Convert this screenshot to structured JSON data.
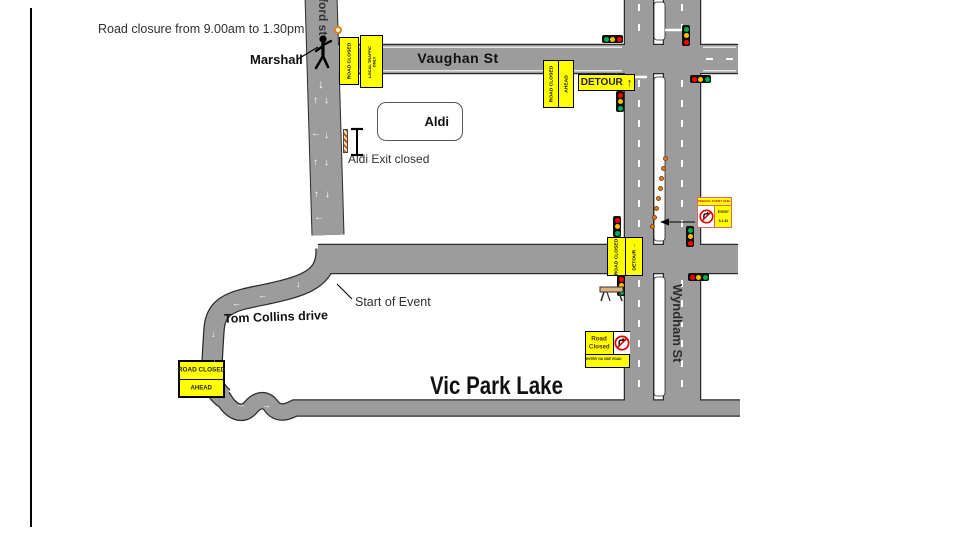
{
  "annotations": {
    "closure_note": "Road closure from 9.00am to 1.30pm",
    "marshall": "Marshall",
    "aldi_exit": "Aldi Exit closed",
    "start_of_event": "Start of Event"
  },
  "streets": {
    "vaughan": "Vaughan St",
    "wyndham": "Wyndham St",
    "tom_collins": "Tom Collins drive",
    "side_street": "lsford st",
    "lake": "Vic Park Lake"
  },
  "places": {
    "aldi": "Aldi"
  },
  "signs": {
    "road_closed": "ROAD CLOSED",
    "ahead": "AHEAD",
    "detour": "DETOUR",
    "small1": "LOCAL TRAFFIC",
    "small2": "ONLY",
    "event_strip": "SPECIAL EVENT 9AM-1.30PM",
    "event1": "EVENT",
    "event2": "9-1.30",
    "road_word": "Road",
    "closed_word": "Closed",
    "enter_via": "ENTER VIA SIDE ROAD"
  },
  "glyphs": {
    "up": "↑",
    "down": "↓",
    "left": "←",
    "right": "→"
  },
  "icons": [
    "no-right-turn-icon",
    "traffic-light-icon",
    "marshal-person-icon",
    "cone-marker-icon",
    "barricade-icon"
  ],
  "colors": {
    "road_gray": "#9c9c9c",
    "road_outline": "#2b2b2b",
    "sign_yellow": "#ffff00",
    "cone_orange": "#e07b20",
    "light_red": "#ff0000",
    "light_yellow": "#ffc000",
    "light_green": "#00b050"
  }
}
